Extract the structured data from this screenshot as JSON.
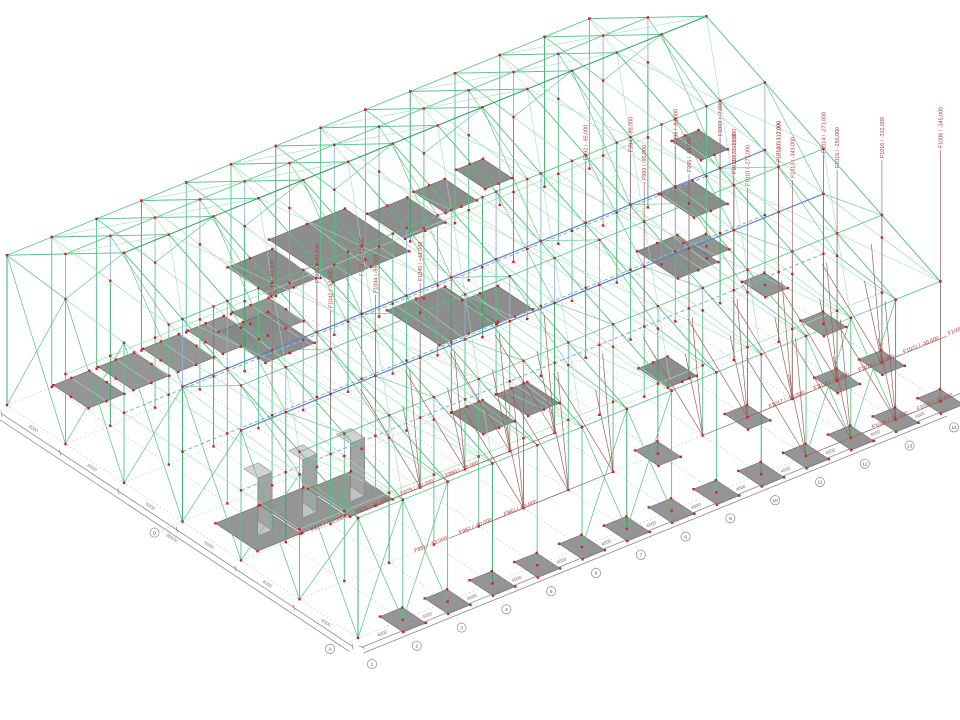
{
  "scene": {
    "label": "3D structural wireframe model with foundation force annotations",
    "background": "#ffffff",
    "width": 960,
    "height": 720
  },
  "colors": {
    "member_green": "#52c186",
    "member_green_light": "#9adebb",
    "member_green_dark": "#2fa562",
    "member_blue": "#8fb2dd",
    "member_blue_dark": "#5b84c4",
    "node_red": "#cc2424",
    "pad_fill": "#8f8f8f",
    "pad_edge": "#6b6b6b",
    "plate_fill": "#878787",
    "pedestal_light": "#c2c2c2",
    "pedestal_dark": "#a3a3a3",
    "rod_maroon": "#9b6262",
    "leader": "#9b6a6a",
    "label_red": "#b43a3a",
    "dim_line": "#8a8a8a",
    "grid_dot": "#b8b8b8",
    "bubble_stroke": "#888888"
  },
  "geometry": {
    "origin": [
      358,
      638
    ],
    "u_vec": [
      44.8,
      -18.2
    ],
    "v_vec": [
      -58.5,
      -38.8
    ],
    "bays_u": 13,
    "bays_v": 6,
    "eave_front": 120,
    "eave_back": 150,
    "ridge": 230,
    "ridge_v": 4,
    "mid_level": 70,
    "pedestal_height": 58
  },
  "foundation_labels": {
    "vertical_center": [
      {
        "text": "F1040 / -41,000",
        "u": 2,
        "v": 3,
        "z": 100,
        "top": 300
      },
      {
        "text": "F1041 / +41,000",
        "u": 3,
        "v": 3,
        "z": 100,
        "top": 285
      },
      {
        "text": "F1042 / -91,000",
        "u": 2,
        "v": 2,
        "z": 100,
        "top": 310
      },
      {
        "text": "F1043 / -41,000",
        "u": 4,
        "v": 3,
        "z": 100,
        "top": 278
      },
      {
        "text": "F1044 / -95,000",
        "u": 3,
        "v": 2,
        "z": 100,
        "top": 295
      },
      {
        "text": "F1045 / +41,000",
        "u": 4,
        "v": 2,
        "z": 100,
        "top": 283
      }
    ],
    "vertical_top_center": [
      {
        "text": "F992 / -95,000",
        "u": 9,
        "v": 3,
        "z": 120,
        "top": 162
      },
      {
        "text": "F993 / -90,000",
        "u": 9,
        "v": 2,
        "z": 70,
        "top": 182
      },
      {
        "text": "F994 / -85,000",
        "u": 10,
        "v": 3,
        "z": 120,
        "top": 154
      },
      {
        "text": "F995 / -55,000",
        "u": 10,
        "v": 2,
        "z": 70,
        "top": 174
      },
      {
        "text": "F996 / -81,000",
        "u": 11,
        "v": 3,
        "z": 120,
        "top": 146
      },
      {
        "text": "F997 / -35,000",
        "u": 11,
        "v": 2,
        "z": 70,
        "top": 166
      },
      {
        "text": "F1003 / -7,000",
        "u": 12,
        "v": 3,
        "z": 120,
        "top": 138
      },
      {
        "text": "F1005 / -7,000",
        "u": 12,
        "v": 2,
        "z": 70,
        "top": 158
      }
    ],
    "vertical_top_right": [
      {
        "text": "F1010 / -271,000",
        "u": 10,
        "v": 1,
        "z": 0,
        "top": 188
      },
      {
        "text": "F1011 / -250,000",
        "u": 11,
        "v": 2,
        "z": 0,
        "top": 176
      },
      {
        "text": "F1012 / -312,000",
        "u": 12,
        "v": 2,
        "z": 0,
        "top": 164
      },
      {
        "text": "F1013 / -343,000",
        "u": 11,
        "v": 1,
        "z": 0,
        "top": 180
      },
      {
        "text": "F1014 / -271,000",
        "u": 13,
        "v": 2,
        "z": 0,
        "top": 155
      },
      {
        "text": "F1015 / -250,000",
        "u": 12,
        "v": 1,
        "z": 0,
        "top": 170
      },
      {
        "text": "F1016 / -312,000",
        "u": 13,
        "v": 1,
        "z": 0,
        "top": 160
      },
      {
        "text": "F1006 / -345,000",
        "u": 13,
        "v": 0,
        "z": 0,
        "top": 150
      }
    ],
    "diagonal_right": [
      {
        "text": "F1017 / -13,000",
        "u": 9,
        "v": 1
      },
      {
        "text": "F1018 / -13,000",
        "u": 10,
        "v": 1
      },
      {
        "text": "F1019 / -30,000",
        "u": 10,
        "v": 0
      },
      {
        "text": "F1020 / -60,000",
        "u": 11,
        "v": 0
      },
      {
        "text": "F1021 / -13,000",
        "u": 11,
        "v": 1
      },
      {
        "text": "F1022 / -30,000",
        "u": 12,
        "v": 1
      },
      {
        "text": "F1023 / -13,000",
        "u": 12,
        "v": 0
      },
      {
        "text": "F1009 / -60,000",
        "u": 13,
        "v": 1
      }
    ],
    "diagonal_bottom": [
      {
        "text": "F977 / -13,000",
        "u": 4,
        "v": 2
      },
      {
        "text": "F978 / -30,000",
        "u": 5,
        "v": 2
      },
      {
        "text": "F979 / -60,000",
        "u": 6,
        "v": 2
      },
      {
        "text": "F980 / -18,000",
        "u": 7,
        "v": 2
      },
      {
        "text": "F981 / -13,000",
        "u": 5,
        "v": 1
      },
      {
        "text": "F982 / -30,000",
        "u": 6,
        "v": 1
      },
      {
        "text": "F983 / -60,000",
        "u": 7,
        "v": 1
      }
    ]
  },
  "foundations": {
    "front_row_u": [
      1,
      2,
      3,
      4,
      5,
      6,
      7,
      8,
      9,
      10,
      11,
      12,
      13
    ],
    "right_col_v": [
      1,
      2,
      3,
      4
    ],
    "inner_pads": [
      {
        "u": 8,
        "v": 1
      },
      {
        "u": 10,
        "v": 1
      },
      {
        "u": 12,
        "v": 1
      }
    ],
    "elevated_row": [
      {
        "u": 0,
        "v": 4.6,
        "z": 70
      },
      {
        "u": 1,
        "v": 4.6,
        "z": 70
      },
      {
        "u": 2,
        "v": 4.6,
        "z": 70
      },
      {
        "u": 3,
        "v": 4.6,
        "z": 70
      },
      {
        "u": 4,
        "v": 4.6,
        "z": 70
      }
    ],
    "floor_plates": [
      {
        "u": 4.8,
        "v": 4.0,
        "z": 150,
        "w": 1.7,
        "d": 1.1
      },
      {
        "u": 3.3,
        "v": 4.0,
        "z": 150,
        "w": 1.0,
        "d": 0.75
      },
      {
        "u": 6.3,
        "v": 4.0,
        "z": 150,
        "w": 0.9,
        "d": 0.65
      },
      {
        "u": 7.3,
        "v": 4.1,
        "z": 150,
        "w": 0.7,
        "d": 0.55
      },
      {
        "u": 8.3,
        "v": 4.2,
        "z": 150,
        "w": 0.6,
        "d": 0.5
      },
      {
        "u": 2.4,
        "v": 3.4,
        "z": 125,
        "w": 1.1,
        "d": 0.8
      },
      {
        "u": 5.8,
        "v": 3.0,
        "z": 100,
        "w": 1.3,
        "d": 0.9
      },
      {
        "u": 6.9,
        "v": 2.9,
        "z": 95,
        "w": 0.8,
        "d": 0.6
      },
      {
        "u": 10.4,
        "v": 2.5,
        "z": 95,
        "w": 0.9,
        "d": 0.7
      },
      {
        "u": 11.4,
        "v": 3.0,
        "z": 115,
        "w": 0.75,
        "d": 0.6
      },
      {
        "u": 12.2,
        "v": 3.5,
        "z": 135,
        "w": 0.6,
        "d": 0.5
      },
      {
        "u": 5.4,
        "v": 2.0,
        "z": 45,
        "w": 0.7,
        "d": 0.55
      },
      {
        "u": 6.4,
        "v": 2.0,
        "z": 45,
        "w": 0.7,
        "d": 0.55
      },
      {
        "u": 9.0,
        "v": 1.6,
        "z": 40,
        "w": 0.65,
        "d": 0.5
      }
    ],
    "pedestals": [
      {
        "u": 0.9,
        "v": 2.4
      },
      {
        "u": 1.9,
        "v": 2.4
      },
      {
        "u": 2.9,
        "v": 2.35
      }
    ]
  },
  "dimensions": {
    "bottom": {
      "segment_label": "4000",
      "segments": 13,
      "axis_bubbles": [
        "1",
        "2",
        "3",
        "4",
        "5",
        "6",
        "7",
        "8",
        "9",
        "10",
        "11",
        "12",
        "13",
        "14"
      ]
    },
    "left": {
      "segment_label": "6000",
      "segments": 6,
      "total_label": "36000",
      "axis_bubbles": [
        {
          "v": 0,
          "label": "A"
        },
        {
          "v": 3,
          "label": "D"
        }
      ]
    }
  }
}
